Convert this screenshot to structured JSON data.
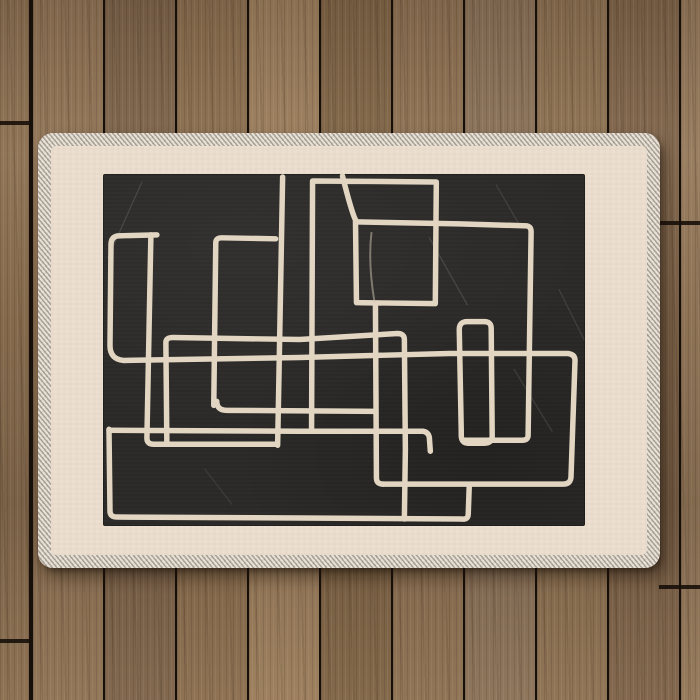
{
  "scene": {
    "title": "Abstract line art area rug on wooden deck",
    "rug_description": "Rectangular mat with stitched serged edge, cream border and black art field"
  },
  "palette": {
    "gap": "#17100a",
    "rug_edge": "#d6cdc1",
    "rug_field": "#ecdfd0",
    "panel": "#2a2927",
    "line": "#e2d6c2",
    "faint_line": "#cfc4b2",
    "scratch": "#ffffff",
    "shadow": "rgba(25,15,6,0.45)"
  },
  "wood": {
    "planks": [
      {
        "x": 0,
        "w": 29,
        "c": "#8a6e50"
      },
      {
        "x": 33,
        "w": 70,
        "c": "#8f7254"
      },
      {
        "x": 105,
        "w": 70,
        "c": "#7d634a"
      },
      {
        "x": 177,
        "w": 70,
        "c": "#8a6d4e"
      },
      {
        "x": 249,
        "w": 70,
        "c": "#9a7c5b"
      },
      {
        "x": 321,
        "w": 70,
        "c": "#7f6446"
      },
      {
        "x": 393,
        "w": 70,
        "c": "#8d7052"
      },
      {
        "x": 465,
        "w": 70,
        "c": "#8a7158"
      },
      {
        "x": 537,
        "w": 70,
        "c": "#8c7051"
      },
      {
        "x": 609,
        "w": 70,
        "c": "#7e6349"
      },
      {
        "x": 681,
        "w": 19,
        "c": "#937759"
      }
    ],
    "joints": [
      {
        "x": 0,
        "w": 31,
        "y": 121
      },
      {
        "x": 659,
        "w": 41,
        "y": 221
      },
      {
        "x": 659,
        "w": 41,
        "y": 585
      },
      {
        "x": 0,
        "w": 31,
        "y": 639
      }
    ]
  },
  "rug": {
    "x": 38,
    "y": 133,
    "w": 622,
    "h": 435,
    "edge_width": 13,
    "panel": {
      "x": 65,
      "y": 41,
      "w": 482,
      "h": 352
    }
  },
  "artwork": {
    "viewBox": "103 174 483 353",
    "stroke_width": 5.5,
    "strokes": [
      "M157,235 L118,236 Q111,237 111,245 L110,346 Q110,360 124,361 L300,358 L450,354 L569,354 Q576,355 576,361 L572,477 Q572,485 564,485 L383,485",
      "M151,235 L147,439 Q147,445 154,445 L277,445",
      "M214,406 L216,243 Q216,238 222,238 L276,239",
      "M283,177 L280,340 L278,446",
      "M217,402 Q217,411 227,411 L376,412",
      "M167,445 L166,343 Q166,338 173,338 L300,340 L398,334 Q405,334 405,340 L406,450 L405,520",
      "M376,304 L377,479 Q377,485 384,485",
      "M343,176 Q352,212 356,220 L357,303 L436,304 L437,182 L313,181 L312,430",
      "M357,222 L460,224 L528,226 Q532,227 532,232 L529,436 Q529,441 523,441 L464,441",
      "M462,432 L460,330 Q460,322 468,322 L485,322 Q492,322 492,329 L493,437 Q493,444 485,444 L469,444 Q462,444 462,436 Z",
      "M109,431 L300,432 L424,432 Q429,433 430,438 L431,452",
      "M109,430 L110,512 Q110,518 117,518 L300,519 L462,520 Q469,521 469,515 L470,487"
    ],
    "faint_strokes": [
      {
        "d": "M372,233 C369,258 372,284 375,302",
        "w": 2,
        "o": 0.5
      }
    ],
    "scratches": [
      {
        "d": "M108,258 L142,182",
        "o": 0.12
      },
      {
        "d": "M430,238 L468,305",
        "o": 0.12
      },
      {
        "d": "M515,370 L553,432",
        "o": 0.1
      },
      {
        "d": "M497,185 L522,228",
        "o": 0.1
      },
      {
        "d": "M205,470 L232,505",
        "o": 0.08
      },
      {
        "d": "M560,290 L585,340",
        "o": 0.1
      }
    ]
  }
}
